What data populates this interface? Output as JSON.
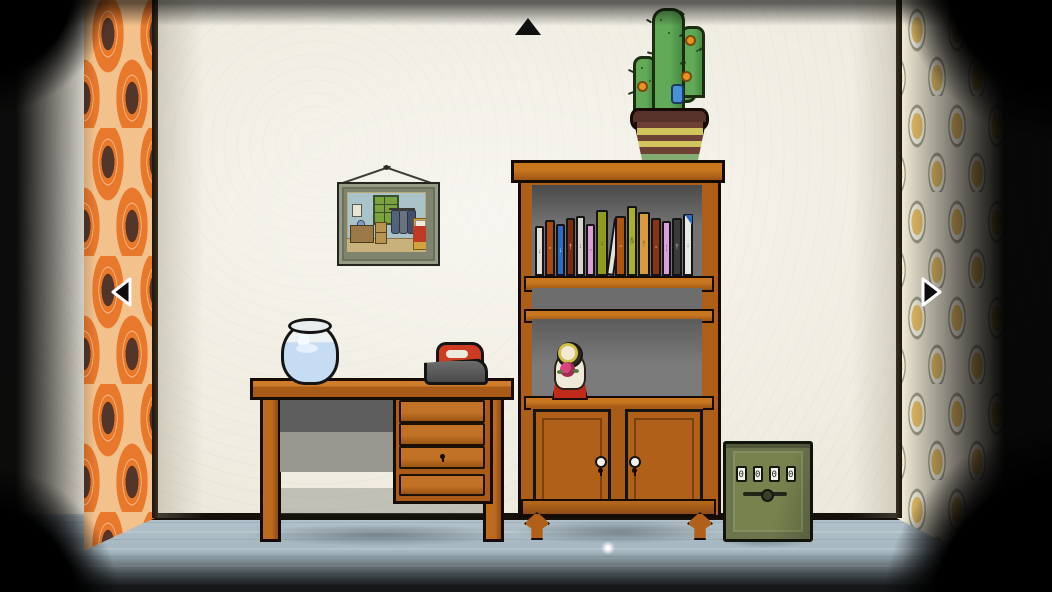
{
  "scene": {
    "name": "living-room view with desk, bookcase and safe",
    "palette": {
      "wall": "#edeadd",
      "floor": "#a3b4be",
      "wood": "#ad5f18",
      "safe_green": "#77824f",
      "wallpaper_left_orange": "#e8782c",
      "wallpaper_right_yellow": "#ecc46a",
      "iron_red": "#cd3b20",
      "doll_red": "#c12a1a"
    }
  },
  "nav": {
    "up": "up-arrow",
    "left": "left-arrow",
    "right": "right-arrow"
  },
  "painting": {
    "label": "Bedroom in Arles"
  },
  "safe": {
    "dials": [
      "0",
      "0",
      "0",
      "0"
    ]
  },
  "bookshelf": {
    "books": [
      {
        "c": "#dedede",
        "h": 50,
        "w": 9,
        "sym": "↓",
        "fg": "rgba(40,40,40,.6)"
      },
      {
        "c": "#a64a12",
        "h": 56,
        "w": 10,
        "sym": "▫",
        "fg": "rgba(255,240,220,.75)"
      },
      {
        "c": "#2f6bc4",
        "h": 52,
        "w": 9,
        "sym": "↓",
        "fg": "rgba(240,245,255,.8)"
      },
      {
        "c": "#7c2a10",
        "h": 58,
        "w": 9,
        "sym": "†",
        "fg": "rgba(255,235,220,.7)"
      },
      {
        "c": "#d6d4cc",
        "h": 60,
        "w": 9,
        "sym": "↓",
        "fg": "rgba(40,40,40,.55)"
      },
      {
        "c": "#e09ed8",
        "h": 52,
        "w": 9,
        "sym": "▫",
        "fg": "rgba(60,30,60,.6)"
      },
      {
        "c": "#8f9c1e",
        "h": 66,
        "w": 12,
        "sym": "↓",
        "fg": "rgba(30,40,10,.6)"
      },
      {
        "c": "#e4e2da",
        "h": 58,
        "w": 8,
        "sym": "",
        "fg": "rgba(40,40,40,.6)",
        "tilt": true,
        "tip": "#2b2b2b"
      },
      {
        "c": "#b0540e",
        "h": 60,
        "w": 11,
        "sym": "▫",
        "fg": "rgba(255,240,220,.75)"
      },
      {
        "c": "#aab327",
        "h": 70,
        "w": 10,
        "sym": "§",
        "fg": "rgba(35,45,10,.65)"
      },
      {
        "c": "#d89b41",
        "h": 64,
        "w": 12,
        "sym": "†",
        "fg": "rgba(70,45,10,.65)"
      },
      {
        "c": "#8a3512",
        "h": 58,
        "w": 10,
        "sym": "▫",
        "fg": "rgba(255,235,220,.7)"
      },
      {
        "c": "#da9fe0",
        "h": 55,
        "w": 9,
        "sym": "¦",
        "fg": "rgba(70,30,70,.6)"
      },
      {
        "c": "#3a3a3a",
        "h": 58,
        "w": 10,
        "sym": "†",
        "fg": "rgba(235,235,235,.7)"
      },
      {
        "c": "#e8e8e4",
        "h": 62,
        "w": 10,
        "sym": "↓",
        "fg": "rgba(40,40,40,.55)",
        "tip": "#2f6bc4"
      }
    ]
  },
  "cactus": {
    "pot_stripes": [
      "#6d4036",
      "#d2c45c",
      "#6d4036",
      "#d2c45c",
      "#6d4036",
      "#84ab70"
    ]
  }
}
